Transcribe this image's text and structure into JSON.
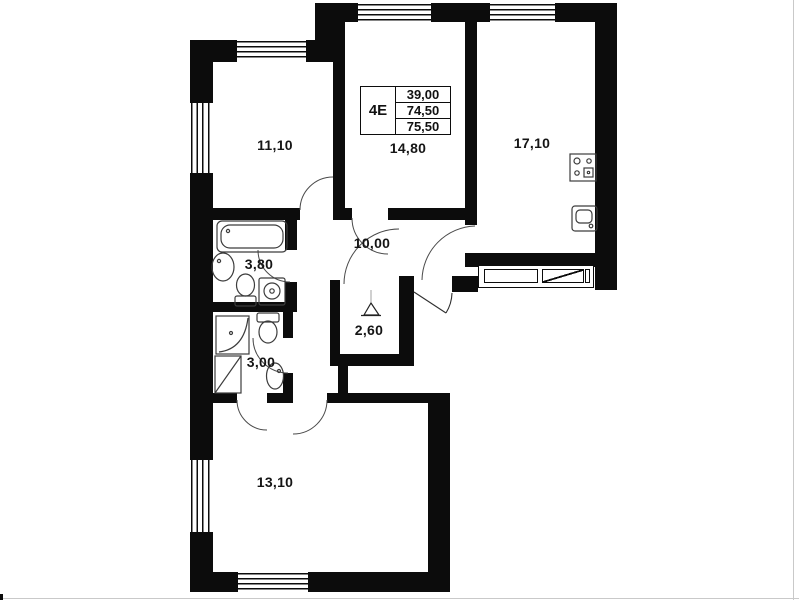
{
  "plan": {
    "type": "apartment_floor_plan",
    "wall_color": "#0c0c0c",
    "legend": {
      "code": "4E",
      "rows": [
        "39,00",
        "74,50",
        "75,50"
      ]
    },
    "rooms": [
      {
        "id": "room-11-10",
        "label": "11,10"
      },
      {
        "id": "room-14-80",
        "label": "14,80"
      },
      {
        "id": "kitchen-17-10",
        "label": "17,10"
      },
      {
        "id": "hall-10-00",
        "label": "10,00"
      },
      {
        "id": "bath-3-80",
        "label": "3,80"
      },
      {
        "id": "wc-3-00",
        "label": "3,00"
      },
      {
        "id": "closet-2-60",
        "label": "2,60"
      },
      {
        "id": "room-13-10",
        "label": "13,10"
      }
    ]
  }
}
